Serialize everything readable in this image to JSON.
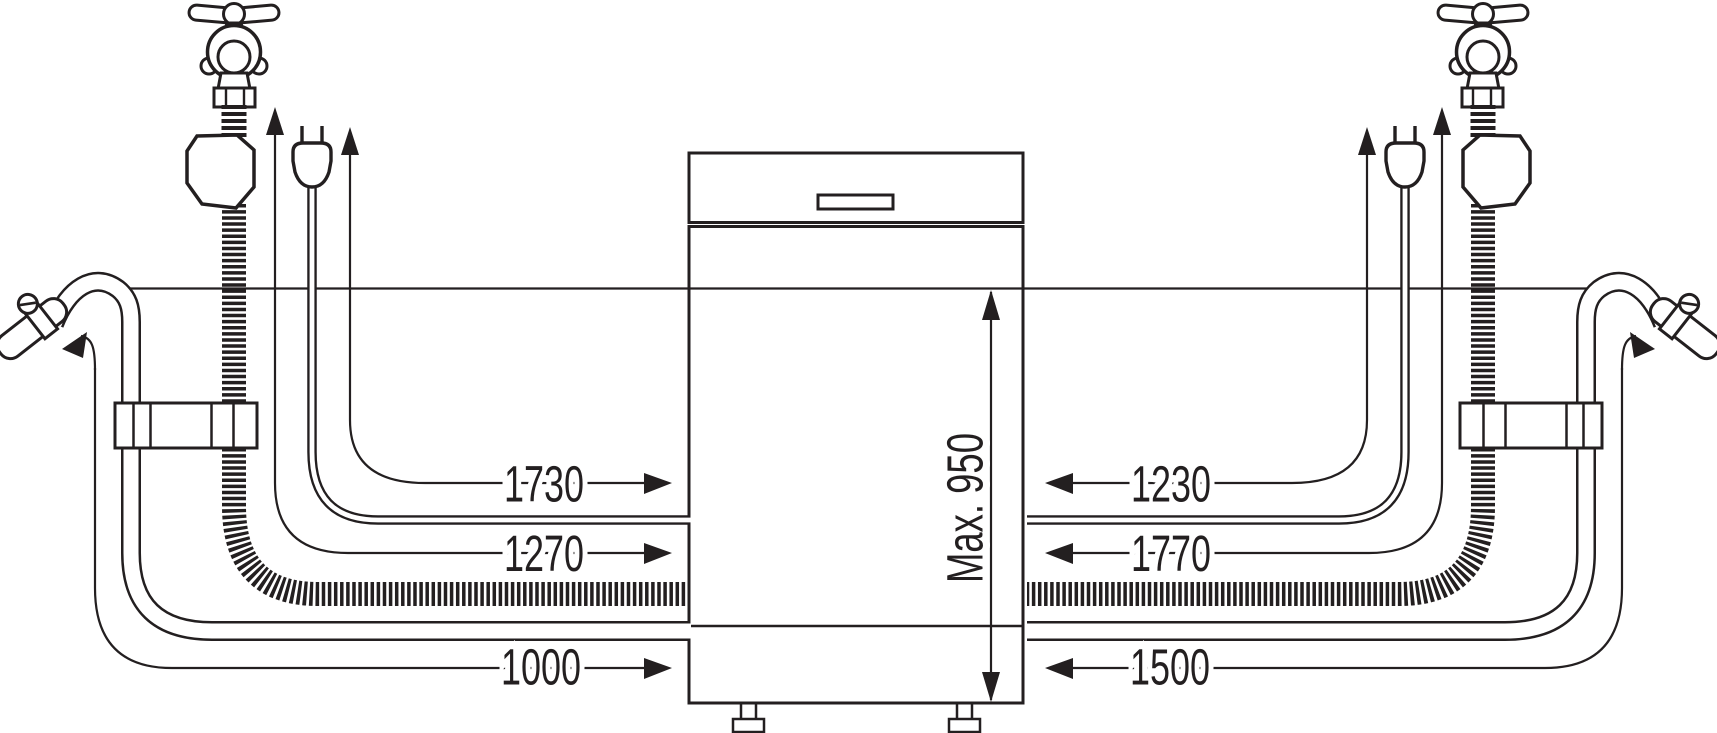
{
  "diagram": {
    "description": "dishwasher-installation-connection-lengths",
    "dims": {
      "left": [
        "1730",
        "1270",
        "1000"
      ],
      "right": [
        "1230",
        "1770",
        "1500"
      ],
      "height_limit": "Max. 950"
    },
    "colors": {
      "ink": "#231f20",
      "background": "#ffffff"
    }
  }
}
